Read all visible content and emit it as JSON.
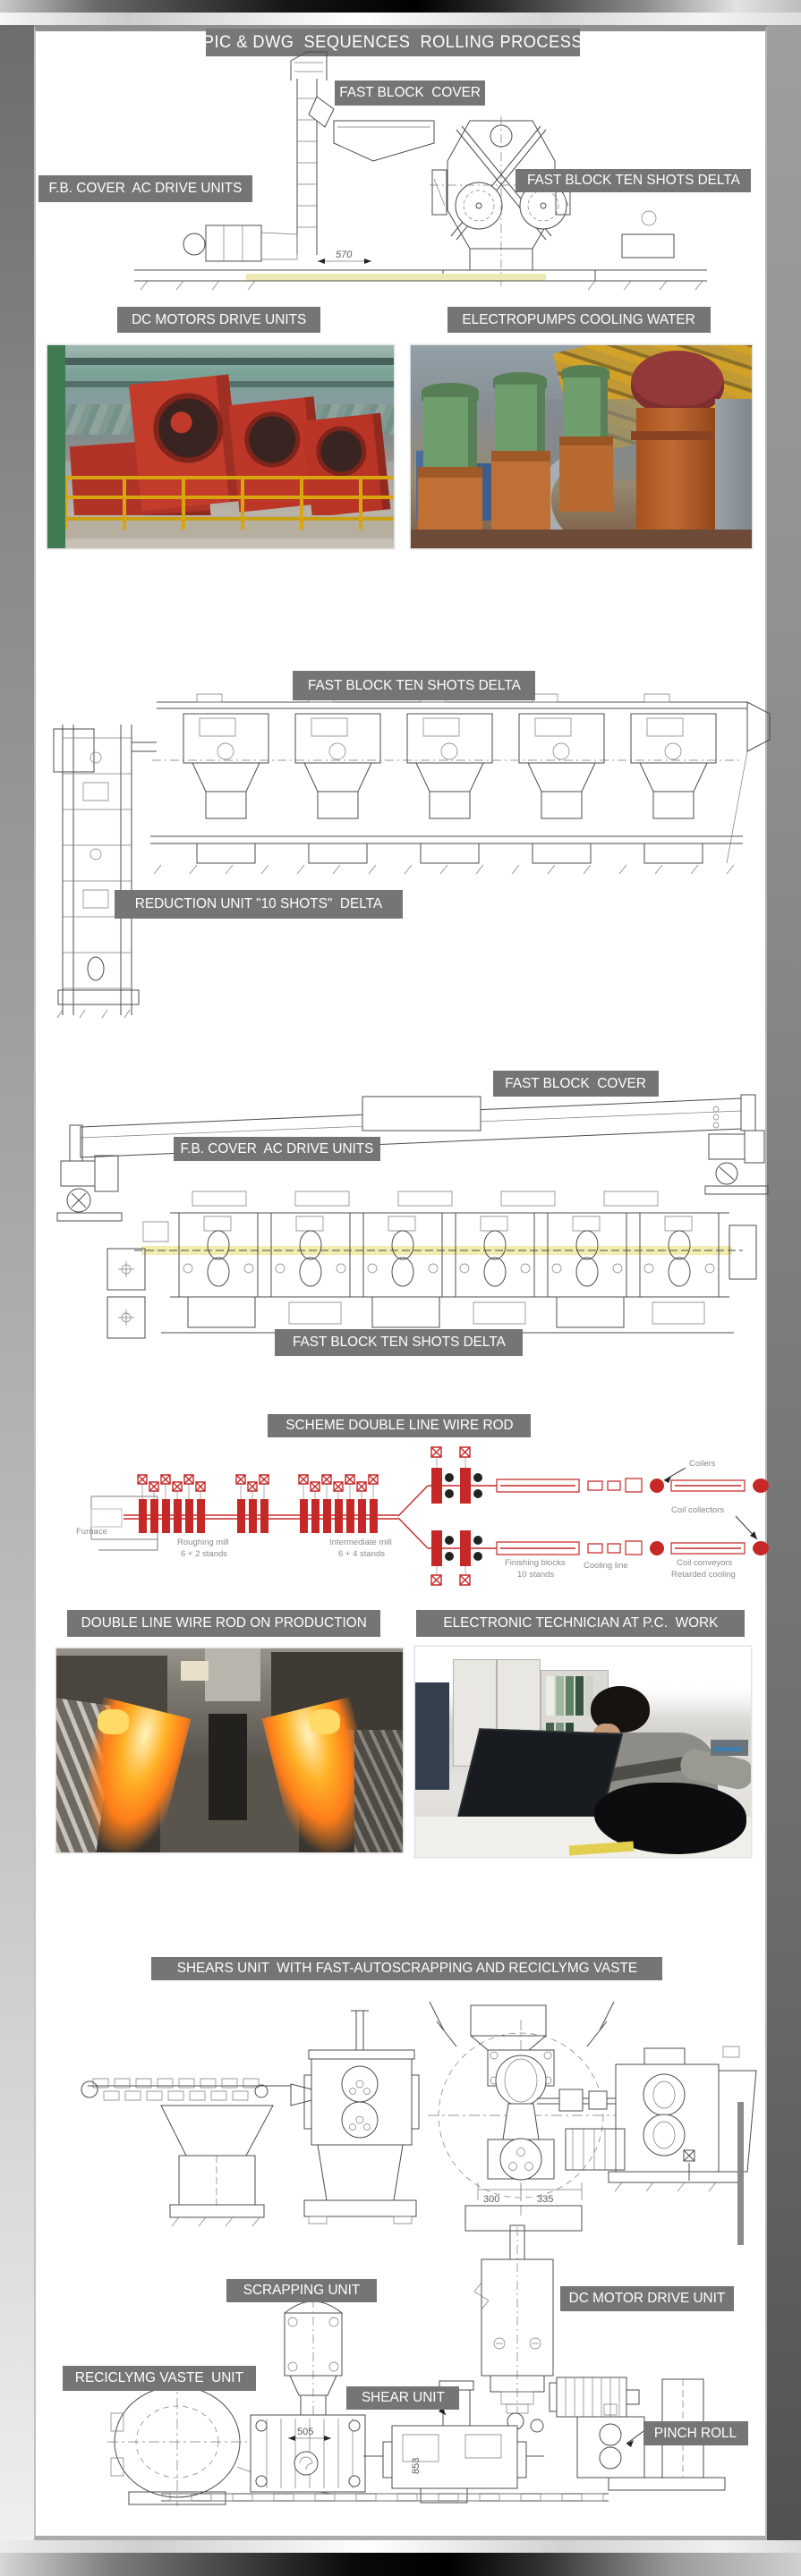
{
  "page": {
    "title": "PIC & DWG  SEQUENCES  ROLLING PROCESS"
  },
  "labels": {
    "fast_block_cover_1": "FAST BLOCK  COVER",
    "fb_cover_ac_drive_units_1": "F.B. COVER  AC DRIVE UNITS",
    "fast_block_ten_shots_delta_1": "FAST BLOCK TEN SHOTS DELTA",
    "dc_motors_drive_units": "DC MOTORS DRIVE UNITS",
    "electropumps_cooling_water": "ELECTROPUMPS COOLING WATER",
    "fast_block_ten_shots_delta_2": "FAST BLOCK TEN SHOTS DELTA",
    "reduction_unit": "REDUCTION UNIT \"10 SHOTS\"  DELTA",
    "fast_block_cover_2": "FAST BLOCK  COVER",
    "fb_cover_ac_drive_units_2": "F.B. COVER  AC DRIVE UNITS",
    "fast_block_ten_shots_delta_3": "FAST BLOCK TEN SHOTS DELTA",
    "scheme_double_line_wire_rod": "SCHEME DOUBLE LINE WIRE ROD",
    "double_line_wire_rod_on_production": "DOUBLE LINE WIRE ROD ON PRODUCTION",
    "electronic_technician": "ELECTRONIC TECHNICIAN AT P.C.  WORK",
    "shears_unit": "SHEARS UNIT  WITH FAST-AUTOSCRAPPING AND RECICLYMG VASTE",
    "scrapping_unit": "SCRAPPING UNIT",
    "dc_motor_drive_unit": "DC MOTOR DRIVE UNIT",
    "reciclymg_vaste_unit": "RECICLYMG VASTE  UNIT",
    "shear_unit": "SHEAR UNIT",
    "pinch_roll": "PINCH ROLL"
  },
  "schematic": {
    "furnace": "Furnace",
    "roughing_mill": "Roughing mill",
    "roughing_stands": "6 + 2 stands",
    "intermediate_mill": "Intermediate mill",
    "intermediate_stands": "6 + 4 stands",
    "finishing_blocks": "Finishing blocks",
    "finishing_stands": "10 stands",
    "cooling_line": "Cooling line",
    "coil_conveyors": "Coil conveyors",
    "retarded_cooling": "Retarded cooling",
    "coilers": "Coilers",
    "coil_collectors": "Coil collectors"
  },
  "dimensions": {
    "d570": "570",
    "d300": "300",
    "d335": "335",
    "d505": "505",
    "d853": "853"
  },
  "colors": {
    "label_bg": "#757575",
    "schematic_red": "#c62828",
    "rolling_line_yellow": "#f2ecae",
    "frame_black": "#000000",
    "frame_silver": "#ffffff"
  }
}
